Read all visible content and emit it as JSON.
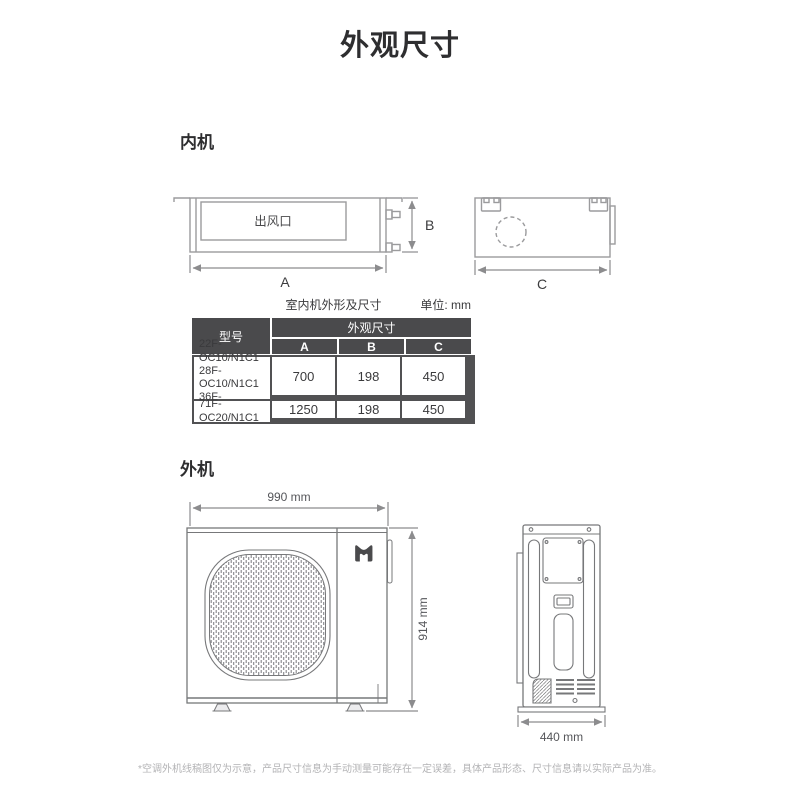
{
  "page": {
    "title": "外观尺寸",
    "footnote": "*空调外机线稿图仅为示意，产品尺寸信息为手动测量可能存在一定误差，具体产品形态、尺寸信息请以实际产品为准。"
  },
  "indoor": {
    "section_label": "内机",
    "front_view": {
      "outlet_label": "出风口",
      "dim_a": "A",
      "dim_b": "B"
    },
    "side_view": {
      "dim_c": "C"
    },
    "table": {
      "caption": "室内机外形及尺寸",
      "unit_label": "单位: mm",
      "header": {
        "model": "型号",
        "dims_group": "外观尺寸",
        "col_a": "A",
        "col_b": "B",
        "col_c": "C"
      },
      "rows": [
        {
          "model": "22F-OC10/N1C1\n28F-OC10/N1C1\n36F-OC10/N1C1",
          "a": "700",
          "b": "198",
          "c": "450"
        },
        {
          "model": "71F-OC20/N1C1",
          "a": "1250",
          "b": "198",
          "c": "450"
        }
      ]
    }
  },
  "outdoor": {
    "section_label": "外机",
    "front_view": {
      "width_label": "990 mm",
      "height_label": "914 mm",
      "logo": "mijia-logo"
    },
    "side_view": {
      "depth_label": "440 mm"
    }
  },
  "colors": {
    "table_header_bg": "#4a4a4c",
    "table_border": "#515153",
    "drawing_line": "#9b9b9d",
    "outdoor_line": "#77787a",
    "dimension_line": "#8c8c8e",
    "footnote_gray": "#b3b3b5"
  }
}
